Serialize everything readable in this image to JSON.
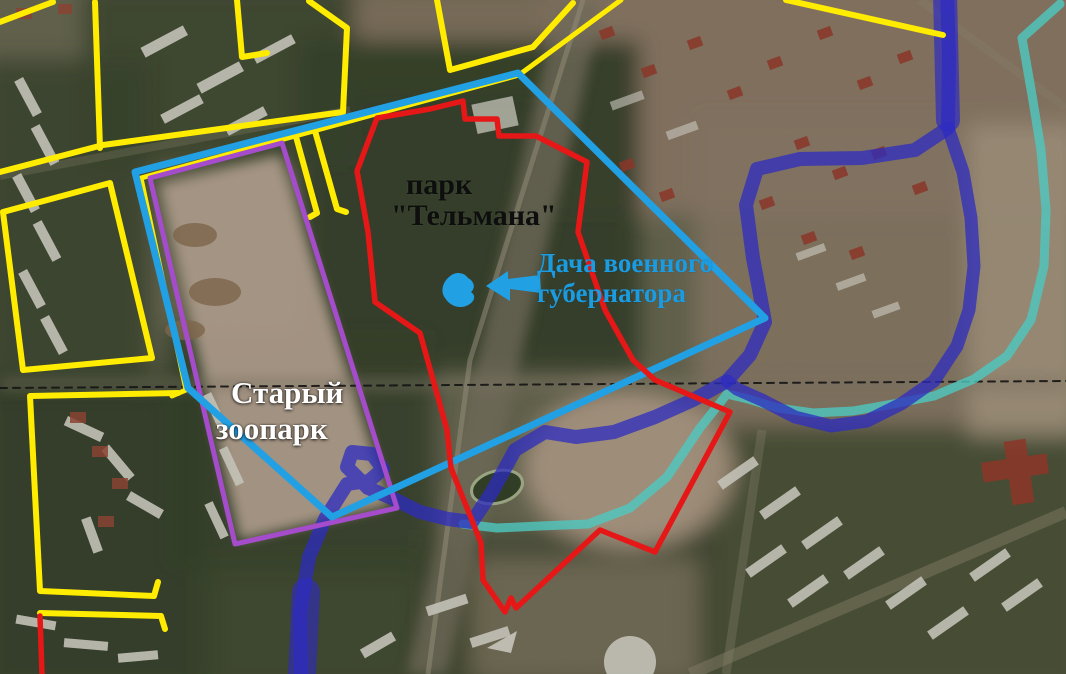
{
  "map": {
    "labels": {
      "park": {
        "line1": "парк",
        "line2": "\"Тельмана\""
      },
      "dacha": {
        "line1": "Дача военного",
        "line2": "губернатора"
      },
      "zoo": {
        "line1": "Старый",
        "line2": "зоопарк"
      }
    },
    "colors": {
      "boundary_yellow": "#ffec00",
      "boundary_purple": "#a44ccb",
      "boundary_cyan": "#22a0e4",
      "boundary_red": "#e61717",
      "river_blue": "#2e2cc0",
      "channel_teal": "#4fc9c0",
      "survey_dash_black": "#141414"
    },
    "shapes": [
      {
        "name": "survey-dashed-line",
        "type": "polyline",
        "color": "survey_dash_black",
        "width": 2,
        "dash": "7 6",
        "opacity": 0.9,
        "points": "0,388 1066,381"
      },
      {
        "name": "teal-channel",
        "type": "polyline",
        "color": "channel_teal",
        "width": 9,
        "opacity": 0.8,
        "points": "1060,4 1022,38 1032,95 1041,150 1046,210 1044,266 1031,320 1007,356 974,379 934,396 893,404 853,411 813,413 778,408 748,399 727,394 700,428 667,477 630,508 588,524 540,526 497,528 463,524"
      },
      {
        "name": "river-top-wide",
        "type": "polyline",
        "color": "river_blue",
        "width": 24,
        "opacity": 0.7,
        "points": "945,-6 948,120"
      },
      {
        "name": "river-main",
        "type": "polyline",
        "color": "river_blue",
        "width": 14,
        "opacity": 0.75,
        "points": "947,-8 949,55 948,128 915,150 862,158 800,159 757,169 746,205 753,258 761,300 765,322 750,355 727,381 693,400 655,417 614,432 576,437 545,432 515,450 492,492 472,522 448,519 420,512 396,500 368,488 347,467 352,452 372,454 383,469 369,481 347,484 325,519 309,557 300,612 301,674"
      },
      {
        "name": "river-east-arm",
        "type": "polyline",
        "color": "river_blue",
        "width": 13,
        "opacity": 0.75,
        "points": "948,128 963,172 971,218 974,266 969,310 957,346 934,381 901,404 867,421 831,426 795,417 762,400 737,389 727,381"
      },
      {
        "name": "river-bottom-wide",
        "type": "polyline",
        "color": "river_blue",
        "width": 28,
        "opacity": 0.62,
        "points": "306,592 302,674"
      },
      {
        "name": "yellow-corner-topleft",
        "type": "polyline",
        "color": "boundary_yellow",
        "width": 6,
        "points": "53,2 0,22"
      },
      {
        "name": "yellow-block-a-left",
        "type": "polyline",
        "color": "boundary_yellow",
        "width": 6,
        "points": "95,2 100,148"
      },
      {
        "name": "yellow-block-a-edge",
        "type": "polyline",
        "color": "boundary_yellow",
        "width": 6,
        "points": "0,172 103,145 343,112 347,28 309,1"
      },
      {
        "name": "yellow-street-l",
        "type": "polyline",
        "color": "boundary_yellow",
        "width": 6,
        "points": "237,0 242,57 267,53"
      },
      {
        "name": "yellow-zigzag-top",
        "type": "polyline",
        "color": "boundary_yellow",
        "width": 6,
        "points": "437,0 450,70 533,47 573,3"
      },
      {
        "name": "yellow-under-cyan",
        "type": "polyline",
        "color": "boundary_yellow",
        "width": 5,
        "points": "621,0 519,75 141,178 186,390 172,396"
      },
      {
        "name": "yellow-street-pair-a",
        "type": "polyline",
        "color": "boundary_yellow",
        "width": 6,
        "points": "295,133 317,213 310,217"
      },
      {
        "name": "yellow-street-pair-b",
        "type": "polyline",
        "color": "boundary_yellow",
        "width": 6,
        "points": "315,131 337,209 346,212"
      },
      {
        "name": "yellow-diag-topright",
        "type": "polyline",
        "color": "boundary_yellow",
        "width": 6,
        "points": "786,0 943,35"
      },
      {
        "name": "yellow-block-b",
        "type": "polygon",
        "color": "boundary_yellow",
        "width": 6,
        "points": "3,212 110,183 152,358 23,370"
      },
      {
        "name": "yellow-block-c",
        "type": "polyline",
        "color": "boundary_yellow",
        "width": 6,
        "points": "178,393 30,396 40,591 154,596 158,582"
      },
      {
        "name": "yellow-line-d",
        "type": "polyline",
        "color": "boundary_yellow",
        "width": 6,
        "points": "40,613 161,616 165,629"
      },
      {
        "name": "purple-zoo-outline",
        "type": "polygon",
        "color": "boundary_purple",
        "width": 5,
        "points": "150,178 282,143 397,508 235,544"
      },
      {
        "name": "cyan-region-outline",
        "type": "polygon",
        "color": "boundary_cyan",
        "width": 7,
        "points": "135,172 518,73 765,318 332,517 188,388"
      },
      {
        "name": "red-park-outline",
        "type": "polygon",
        "color": "boundary_red",
        "width": 5.5,
        "points": "377,118 430,109 463,101 465,119 497,119 499,136 536,136 587,162 578,232 605,310 633,360 655,380 730,412 655,552 600,530 516,608 511,598 505,612 483,580 481,543 451,468 447,430 420,333 375,302 368,232 357,171"
      },
      {
        "name": "red-line-bottomleft",
        "type": "polyline",
        "color": "boundary_red",
        "width": 5.5,
        "points": "40,616 42,674"
      },
      {
        "name": "dacha-arrow",
        "type": "polygon",
        "color": "none",
        "width": 0,
        "fill": "boundary_cyan",
        "points": "486,286 508,271 508,279 540,275 541,293 510,289 510,301"
      },
      {
        "name": "dacha-pond",
        "type": "path",
        "color": "none",
        "width": 0,
        "fill": "boundary_cyan",
        "d": "M449,277 C455,271 464,272 468,278 C474,281 476,288 471,292 C477,296 474,303 466,306 C458,309 449,305 445,298 C440,291 443,282 449,277 Z"
      }
    ]
  }
}
